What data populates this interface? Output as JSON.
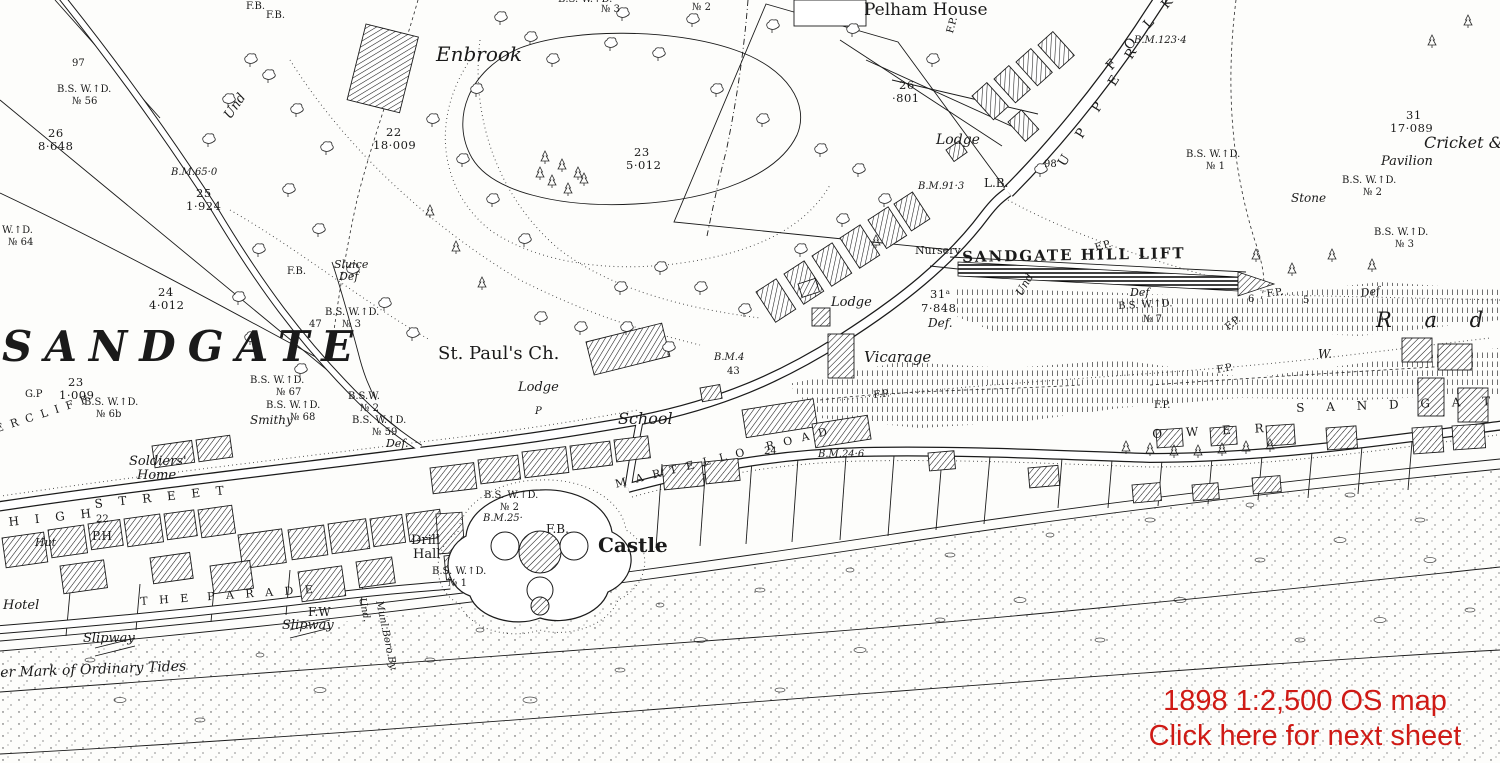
{
  "overlay": {
    "line1": "1898 1:2,500 OS map",
    "line2": "Click here for next sheet",
    "color": "#cf1a15"
  },
  "colors": {
    "ink": "#1b1b1b",
    "paper": "#fdfdfb"
  },
  "map": {
    "labels": [
      {
        "t": "F.B.",
        "x": 246,
        "y": 2,
        "c": "sm"
      },
      {
        "t": "F.B.",
        "x": 266,
        "y": 11,
        "c": "sm"
      },
      {
        "t": "97",
        "x": 72,
        "y": 59,
        "c": "sm"
      },
      {
        "t": "B.S. W.↑D.",
        "x": 57,
        "y": 85,
        "c": "sm"
      },
      {
        "t": "№ 56",
        "x": 72,
        "y": 97,
        "c": "sm"
      },
      {
        "t": "26",
        "x": 48,
        "y": 128,
        "c": "num"
      },
      {
        "t": "8·648",
        "x": 38,
        "y": 141,
        "c": "num"
      },
      {
        "t": "Und",
        "x": 222,
        "y": 114,
        "c": "it",
        "r": -55
      },
      {
        "t": "B.M.65·0",
        "x": 171,
        "y": 168,
        "c": "bm"
      },
      {
        "t": "25",
        "x": 196,
        "y": 188,
        "c": "num"
      },
      {
        "t": "1·924",
        "x": 186,
        "y": 201,
        "c": "num"
      },
      {
        "t": "24",
        "x": 158,
        "y": 287,
        "c": "num"
      },
      {
        "t": "4·012",
        "x": 149,
        "y": 300,
        "c": "num"
      },
      {
        "t": "Sluice",
        "x": 334,
        "y": 259,
        "c": "it",
        "s": 11
      },
      {
        "t": "Def",
        "x": 339,
        "y": 271,
        "c": "it",
        "s": 11
      },
      {
        "t": "F.B.",
        "x": 287,
        "y": 267,
        "c": "sm"
      },
      {
        "t": "B.S. W.↑D.",
        "x": 325,
        "y": 308,
        "c": "sm"
      },
      {
        "t": "№ 3",
        "x": 342,
        "y": 320,
        "c": "sm"
      },
      {
        "t": "47",
        "x": 309,
        "y": 320,
        "c": "sm"
      },
      {
        "t": "Enbrook",
        "x": 436,
        "y": 44,
        "c": "itl",
        "s": 20
      },
      {
        "t": "22",
        "x": 386,
        "y": 127,
        "c": "num"
      },
      {
        "t": "18·009",
        "x": 373,
        "y": 140,
        "c": "num"
      },
      {
        "t": "23",
        "x": 634,
        "y": 147,
        "c": "num"
      },
      {
        "t": "5·012",
        "x": 626,
        "y": 160,
        "c": "num"
      },
      {
        "t": "B.S. W.↑D.",
        "x": 558,
        "y": -5,
        "c": "sm"
      },
      {
        "t": "№ 3",
        "x": 601,
        "y": 5,
        "c": "sm"
      },
      {
        "t": "№ 2",
        "x": 692,
        "y": 3,
        "c": "sm"
      },
      {
        "t": "Pelham House",
        "x": 864,
        "y": 2,
        "c": "sfl"
      },
      {
        "t": "26",
        "x": 899,
        "y": 80,
        "c": "num"
      },
      {
        "t": "·801",
        "x": 892,
        "y": 93,
        "c": "num"
      },
      {
        "t": "Lodge",
        "x": 936,
        "y": 133,
        "c": "it",
        "s": 14
      },
      {
        "t": "B.M.91·3",
        "x": 918,
        "y": 182,
        "c": "bm"
      },
      {
        "t": "L.B.",
        "x": 984,
        "y": 177,
        "c": "sf",
        "s": 12
      },
      {
        "t": "98",
        "x": 1044,
        "y": 160,
        "c": "sm"
      },
      {
        "t": "F.P.",
        "x": 946,
        "y": 32,
        "c": "sm",
        "r": -75
      },
      {
        "t": "U P P E R",
        "x": 1056,
        "y": 162,
        "c": "caps",
        "s": 13,
        "ls": 9,
        "r": -58
      },
      {
        "t": "F O L K E",
        "x": 1104,
        "y": 64,
        "c": "caps",
        "s": 13,
        "ls": 7,
        "r": -48
      },
      {
        "t": "B.M.123·4",
        "x": 1134,
        "y": 36,
        "c": "bm"
      },
      {
        "t": "31",
        "x": 1406,
        "y": 110,
        "c": "num"
      },
      {
        "t": "17·089",
        "x": 1390,
        "y": 123,
        "c": "num"
      },
      {
        "t": "Cricket & ",
        "x": 1424,
        "y": 135,
        "c": "itl"
      },
      {
        "t": "Pavilion",
        "x": 1381,
        "y": 155,
        "c": "it"
      },
      {
        "t": "B.S. W.↑D.",
        "x": 1342,
        "y": 176,
        "c": "sm"
      },
      {
        "t": "№ 2",
        "x": 1363,
        "y": 188,
        "c": "sm"
      },
      {
        "t": "Stone",
        "x": 1291,
        "y": 192,
        "c": "it",
        "s": 12
      },
      {
        "t": "B.S. W.↑D.",
        "x": 1374,
        "y": 228,
        "c": "sm"
      },
      {
        "t": "№ 3",
        "x": 1395,
        "y": 240,
        "c": "sm"
      },
      {
        "t": "B.S. W.↑D.",
        "x": 1186,
        "y": 150,
        "c": "sm"
      },
      {
        "t": "№ 1",
        "x": 1206,
        "y": 162,
        "c": "sm"
      },
      {
        "t": "Nursery",
        "x": 915,
        "y": 245,
        "c": "sf",
        "s": 11
      },
      {
        "t": "SANDGATE HILL LIFT",
        "x": 962,
        "y": 250,
        "c": "lift",
        "r": -1,
        "ls": 2
      },
      {
        "t": "Def",
        "x": 1130,
        "y": 287,
        "c": "it",
        "s": 11
      },
      {
        "t": "B.S. W.↑D.",
        "x": 1118,
        "y": 302,
        "c": "sm",
        "r": -3
      },
      {
        "t": "№ 7",
        "x": 1143,
        "y": 315,
        "c": "sm"
      },
      {
        "t": "31ᵃ",
        "x": 930,
        "y": 289,
        "c": "num"
      },
      {
        "t": "7·848",
        "x": 921,
        "y": 303,
        "c": "num"
      },
      {
        "t": "Def.",
        "x": 928,
        "y": 317,
        "c": "it",
        "s": 12
      },
      {
        "t": "Und",
        "x": 1014,
        "y": 292,
        "c": "it",
        "s": 11,
        "r": -60
      },
      {
        "t": "Lodge",
        "x": 831,
        "y": 296,
        "c": "it"
      },
      {
        "t": "Vicarage",
        "x": 864,
        "y": 350,
        "c": "itl",
        "s": 15
      },
      {
        "t": "F.P.",
        "x": 873,
        "y": 391,
        "c": "sm",
        "r": -6
      },
      {
        "t": "F.P.",
        "x": 1094,
        "y": 244,
        "c": "sm",
        "r": -15
      },
      {
        "t": "6",
        "x": 1248,
        "y": 295,
        "c": "sm"
      },
      {
        "t": "F.P.",
        "x": 1266,
        "y": 290,
        "c": "sm",
        "r": -8
      },
      {
        "t": "5",
        "x": 1303,
        "y": 296,
        "c": "sm"
      },
      {
        "t": "F.P.",
        "x": 1224,
        "y": 325,
        "c": "sm",
        "r": -38
      },
      {
        "t": "F.P.",
        "x": 1216,
        "y": 366,
        "c": "sm",
        "r": -10
      },
      {
        "t": "F.P.",
        "x": 1154,
        "y": 401,
        "c": "sm"
      },
      {
        "t": "Def",
        "x": 1360,
        "y": 288,
        "c": "it",
        "s": 11,
        "r": -8
      },
      {
        "t": "R a d n",
        "x": 1376,
        "y": 310,
        "c": "itl",
        "s": 21,
        "ls": 13
      },
      {
        "t": "W.",
        "x": 1318,
        "y": 348,
        "c": "it",
        "s": 12
      },
      {
        "t": "O W E R",
        "x": 1152,
        "y": 428,
        "c": "caps",
        "ls": 10,
        "r": -3
      },
      {
        "t": "S A N D G A T E",
        "x": 1296,
        "y": 402,
        "c": "caps",
        "ls": 9,
        "r": -2
      },
      {
        "t": "St. Paul's Ch.",
        "x": 438,
        "y": 345,
        "c": "sfl",
        "s": 18
      },
      {
        "t": "Lodge",
        "x": 518,
        "y": 381,
        "c": "it"
      },
      {
        "t": "P",
        "x": 535,
        "y": 407,
        "c": "it",
        "s": 10
      },
      {
        "t": "School",
        "x": 618,
        "y": 411,
        "c": "itl"
      },
      {
        "t": "M A R T E L L O   R O A D",
        "x": 614,
        "y": 479,
        "c": "caps",
        "s": 11,
        "ls": 3,
        "r": -14
      },
      {
        "t": "24",
        "x": 764,
        "y": 447,
        "c": "sm"
      },
      {
        "t": "B.M.24·6",
        "x": 818,
        "y": 450,
        "c": "bm"
      },
      {
        "t": "B.M.4",
        "x": 714,
        "y": 353,
        "c": "bm"
      },
      {
        "t": "43",
        "x": 727,
        "y": 367,
        "c": "sm"
      },
      {
        "t": "SANDGATE",
        "x": 2,
        "y": 326,
        "c": "huge"
      },
      {
        "t": "23",
        "x": 68,
        "y": 377,
        "c": "num"
      },
      {
        "t": "1·009",
        "x": 59,
        "y": 390,
        "c": "num"
      },
      {
        "t": "G.P",
        "x": 25,
        "y": 390,
        "c": "sm"
      },
      {
        "t": "B.S. W.↑D.",
        "x": 250,
        "y": 376,
        "c": "sm"
      },
      {
        "t": "№ 67",
        "x": 276,
        "y": 388,
        "c": "sm"
      },
      {
        "t": "B.S. W.↑D.",
        "x": 266,
        "y": 401,
        "c": "sm"
      },
      {
        "t": "№ 68",
        "x": 290,
        "y": 413,
        "c": "sm"
      },
      {
        "t": "B.S. W.↑D.",
        "x": 84,
        "y": 398,
        "c": "sm"
      },
      {
        "t": "№ 6b",
        "x": 96,
        "y": 410,
        "c": "sm"
      },
      {
        "t": "B.S.W.",
        "x": 348,
        "y": 392,
        "c": "sm"
      },
      {
        "t": "№ 2",
        "x": 360,
        "y": 404,
        "c": "sm"
      },
      {
        "t": "B.S. W.↑D.",
        "x": 352,
        "y": 416,
        "c": "sm"
      },
      {
        "t": "№ 59",
        "x": 372,
        "y": 428,
        "c": "sm"
      },
      {
        "t": "Def.",
        "x": 386,
        "y": 438,
        "c": "it",
        "s": 11
      },
      {
        "t": "W.↑D.",
        "x": 2,
        "y": 226,
        "c": "sm"
      },
      {
        "t": "№ 64",
        "x": 8,
        "y": 238,
        "c": "sm"
      },
      {
        "t": "E R C L I F F",
        "x": -6,
        "y": 424,
        "c": "caps",
        "s": 11,
        "ls": 2,
        "r": -18
      },
      {
        "t": "Smithy",
        "x": 250,
        "y": 414,
        "c": "it",
        "s": 12
      },
      {
        "t": "Soldiers'",
        "x": 129,
        "y": 455,
        "c": "it"
      },
      {
        "t": "Home",
        "x": 137,
        "y": 469,
        "c": "it"
      },
      {
        "t": "H I G H",
        "x": 8,
        "y": 516,
        "c": "caps",
        "ls": 6,
        "r": -6
      },
      {
        "t": "S T R E E T",
        "x": 94,
        "y": 498,
        "c": "caps",
        "ls": 6,
        "r": -6
      },
      {
        "t": "22",
        "x": 96,
        "y": 515,
        "c": "sm"
      },
      {
        "t": "P.H",
        "x": 92,
        "y": 530,
        "c": "sf",
        "s": 12
      },
      {
        "t": "Hut",
        "x": 35,
        "y": 537,
        "c": "it",
        "s": 11
      },
      {
        "t": "Hotel",
        "x": 3,
        "y": 599,
        "c": "it"
      },
      {
        "t": "T H E  P A R A D E",
        "x": 140,
        "y": 596,
        "c": "caps",
        "s": 11,
        "ls": 4,
        "r": -4
      },
      {
        "t": "F.W",
        "x": 308,
        "y": 606,
        "c": "sf",
        "s": 12
      },
      {
        "t": "Slipway",
        "x": 282,
        "y": 619,
        "c": "it"
      },
      {
        "t": "Slipway",
        "x": 83,
        "y": 632,
        "c": "it"
      },
      {
        "t": "er Mark of Ordinary Tides",
        "x": 0,
        "y": 666,
        "c": "it",
        "s": 14,
        "r": -2
      },
      {
        "t": "Und.",
        "x": 366,
        "y": 597,
        "c": "it",
        "s": 10,
        "r": 78
      },
      {
        "t": "Munl.Boro.By.",
        "x": 383,
        "y": 600,
        "c": "it",
        "s": 10,
        "r": 78
      },
      {
        "t": "Drill",
        "x": 411,
        "y": 534,
        "c": "sf"
      },
      {
        "t": "Hall",
        "x": 413,
        "y": 548,
        "c": "sf"
      },
      {
        "t": "B.S. W.↑D.",
        "x": 484,
        "y": 491,
        "c": "sm"
      },
      {
        "t": "№ 2",
        "x": 500,
        "y": 503,
        "c": "sm"
      },
      {
        "t": "B.M.25·",
        "x": 483,
        "y": 514,
        "c": "bm"
      },
      {
        "t": "F.B.",
        "x": 546,
        "y": 523,
        "c": "sf",
        "s": 12
      },
      {
        "t": "Castle",
        "x": 598,
        "y": 535,
        "c": "castle"
      },
      {
        "t": "B.S. W.↑D.",
        "x": 432,
        "y": 567,
        "c": "sm"
      },
      {
        "t": "№ 1",
        "x": 448,
        "y": 579,
        "c": "sm"
      }
    ]
  }
}
